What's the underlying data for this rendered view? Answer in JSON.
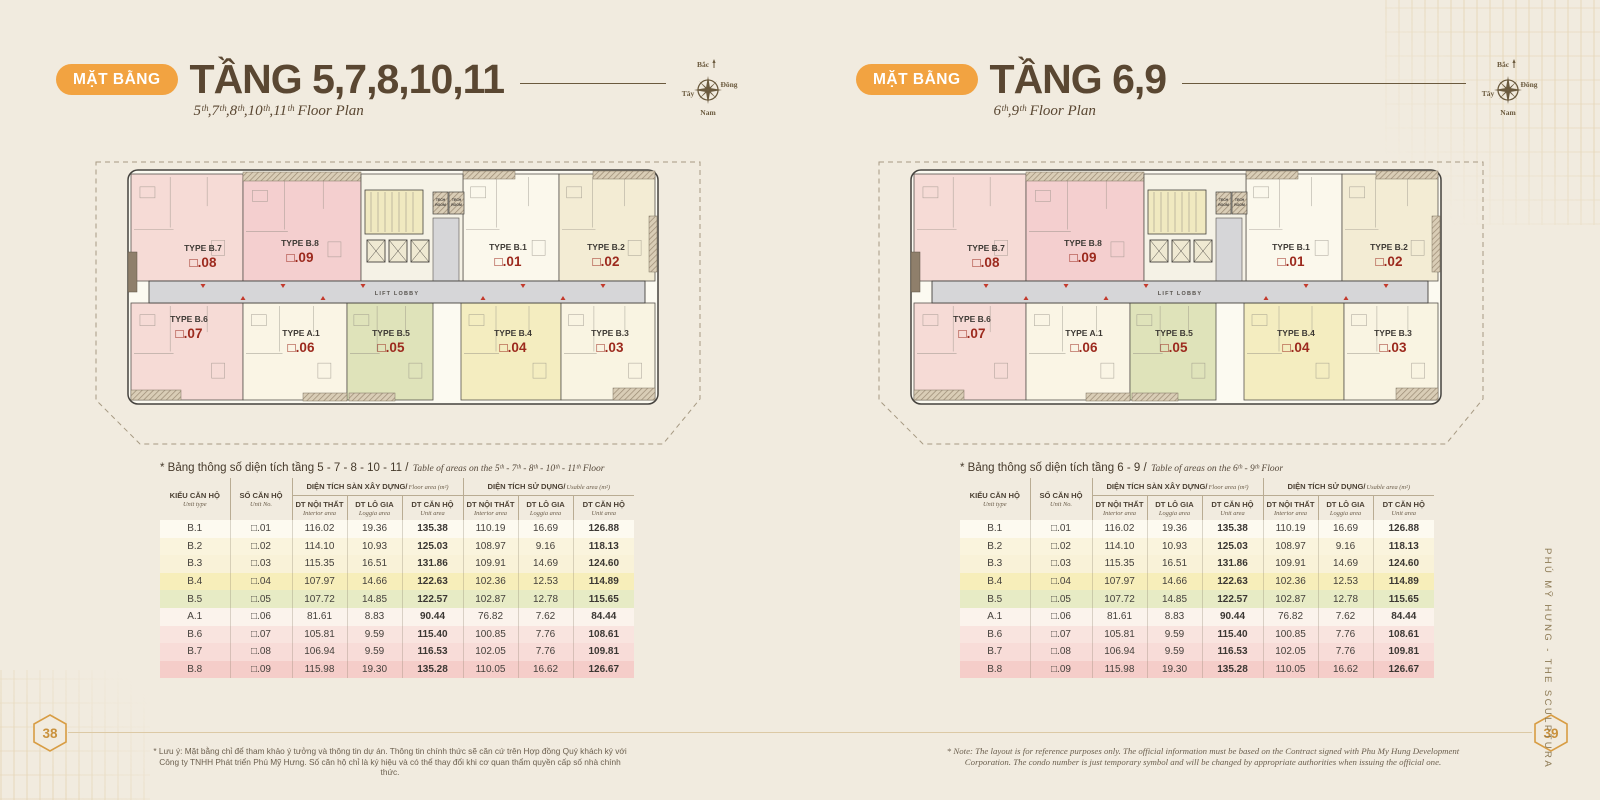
{
  "brand_vertical": "PHÚ MỸ HƯNG  -  THE SCULPTURA",
  "compass": {
    "north": "Bắc",
    "east": "Đông",
    "west": "Tây",
    "south": "Nam"
  },
  "panels": {
    "left": {
      "badge": "MẶT BẰNG",
      "title": "TẦNG 5,7,8,10,11",
      "subtitle": "5ᵗʰ,7ᵗʰ,8ᵗʰ,10ᵗʰ,11ᵗʰ Floor Plan",
      "table_title_vi": "* Bảng thông số diện tích tầng 5 - 7 - 8 - 10 - 11 /",
      "table_title_en": "Table of areas on the 5ᵗʰ - 7ᵗʰ - 8ᵗʰ - 10ᵗʰ - 11ᵗʰ Floor",
      "footnote": "* Lưu ý: Mặt bằng chỉ để tham khảo ý tưởng và thông tin dự án. Thông tin chính thức sẽ căn cứ trên Hợp đồng Quý khách ký với Công ty TNHH Phát triển Phú Mỹ Hưng. Số căn hộ chỉ là ký hiệu và có thể thay đổi khi cơ quan thẩm quyền cấp số nhà chính thức.",
      "page_number": "38"
    },
    "right": {
      "badge": "MẶT BẰNG",
      "title": "TẦNG 6,9",
      "subtitle": "6ᵗʰ,9ᵗʰ Floor Plan",
      "table_title_vi": "* Bảng thông số diện tích tầng 6 - 9 /",
      "table_title_en": "Table of areas on the 6ᵗʰ - 9ᵗʰ Floor",
      "footnote": "* Note: The layout is for reference purposes only. The official information must be based on the Contract signed with Phu My Hung Development Corporation. The condo number is just temporary symbol and will be changed by appropriate authorities when issuing the official one.",
      "page_number": "39"
    }
  },
  "floorplan": {
    "lift_lobby_label": "LIFT LOBBY",
    "tech_room_label": "TECH ROOM",
    "units": [
      {
        "type": "TYPE B.7",
        "no": "□.08"
      },
      {
        "type": "TYPE B.8",
        "no": "□.09"
      },
      {
        "type": "TYPE B.1",
        "no": "□.01"
      },
      {
        "type": "TYPE B.2",
        "no": "□.02"
      },
      {
        "type": "TYPE B.6",
        "no": "□.07"
      },
      {
        "type": "TYPE A.1",
        "no": "□.06"
      },
      {
        "type": "TYPE B.5",
        "no": "□.05"
      },
      {
        "type": "TYPE B.4",
        "no": "□.04"
      },
      {
        "type": "TYPE B.3",
        "no": "□.03"
      }
    ]
  },
  "table": {
    "col1_vi": "KIỂU CĂN HỘ",
    "col1_en": "Unit type",
    "col2_vi": "SỐ CĂN HỘ",
    "col2_en": "Unit No.",
    "group1_vi": "DIỆN TÍCH SÀN XÂY DỰNG/",
    "group1_en": "Floor area (m²)",
    "group2_vi": "DIỆN TÍCH SỬ DỤNG/",
    "group2_en": "Usable area (m²)",
    "sub_vi": [
      "DT NỘI THẤT",
      "DT LÔ GIA",
      "DT CĂN HỘ",
      "DT NỘI THẤT",
      "DT LÔ GIA",
      "DT CĂN HỘ"
    ],
    "sub_en": [
      "Interior area",
      "Loggia area",
      "Unit area",
      "Interior area",
      "Loggia area",
      "Unit area"
    ],
    "rows": [
      {
        "type": "B.1",
        "no": "□.01",
        "values": [
          "116.02",
          "19.36",
          "135.38",
          "110.19",
          "16.69",
          "126.88"
        ]
      },
      {
        "type": "B.2",
        "no": "□.02",
        "values": [
          "114.10",
          "10.93",
          "125.03",
          "108.97",
          "9.16",
          "118.13"
        ]
      },
      {
        "type": "B.3",
        "no": "□.03",
        "values": [
          "115.35",
          "16.51",
          "131.86",
          "109.91",
          "14.69",
          "124.60"
        ]
      },
      {
        "type": "B.4",
        "no": "□.04",
        "values": [
          "107.97",
          "14.66",
          "122.63",
          "102.36",
          "12.53",
          "114.89"
        ]
      },
      {
        "type": "B.5",
        "no": "□.05",
        "values": [
          "107.72",
          "14.85",
          "122.57",
          "102.87",
          "12.78",
          "115.65"
        ]
      },
      {
        "type": "A.1",
        "no": "□.06",
        "values": [
          "81.61",
          "8.83",
          "90.44",
          "76.82",
          "7.62",
          "84.44"
        ]
      },
      {
        "type": "B.6",
        "no": "□.07",
        "values": [
          "105.81",
          "9.59",
          "115.40",
          "100.85",
          "7.76",
          "108.61"
        ]
      },
      {
        "type": "B.7",
        "no": "□.08",
        "values": [
          "106.94",
          "9.59",
          "116.53",
          "102.05",
          "7.76",
          "109.81"
        ]
      },
      {
        "type": "B.8",
        "no": "□.09",
        "values": [
          "115.98",
          "19.30",
          "135.28",
          "110.05",
          "16.62",
          "126.67"
        ]
      }
    ]
  },
  "colors": {
    "badge_orange": "#f2a341",
    "accent_red": "#9c2a1e",
    "hexagon_gold": "#d89d44",
    "row_colors": {
      "B.1": "#fdfaf0",
      "B.2": "#faf4dd",
      "B.3": "#f9f2d8",
      "B.4": "#f7eeba",
      "B.5": "#e7ebc5",
      "A.1": "#fbf3ec",
      "B.6": "#f9e4df",
      "B.7": "#f8dcd8",
      "B.8": "#f5cdc9"
    },
    "unit_colors": {
      "B.7": "#f6dbd6",
      "B.8": "#f4cfcf",
      "B.1": "#fbf8ec",
      "B.2": "#f3ecd4",
      "B.6": "#f6dbd6",
      "A.1": "#faf5e5",
      "B.5": "#dfe3ba",
      "B.4": "#f4edc0",
      "B.3": "#f9f4e2"
    }
  }
}
